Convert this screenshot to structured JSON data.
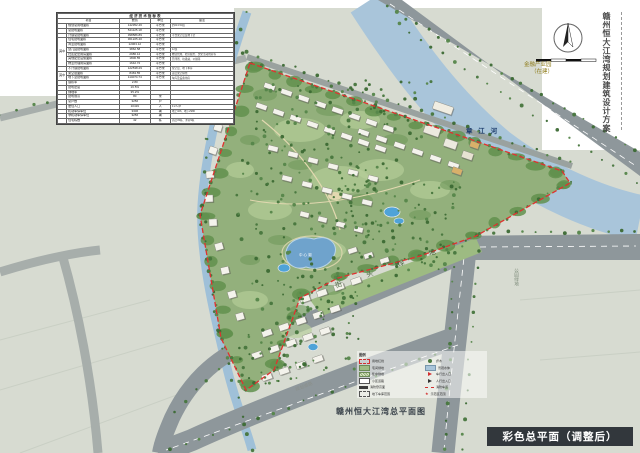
{
  "sheet": {
    "vertical_title": "赣州恒大江湾规划建筑设计方案",
    "banner_title": "彩色总平面（调整后）",
    "plan_caption": "赣州恒大江湾总平面图"
  },
  "map_labels": {
    "river": "章 江 河",
    "financial_park_l1": "金融产业园",
    "financial_park_l2": "（在建）",
    "street_green": "街 头 绿 地",
    "park_green": "公园绿地",
    "lake": "中心湖",
    "road_name": "规划道路"
  },
  "table": {
    "title": "经济技术指标表",
    "headers": [
      "项目",
      "数值",
      "单位",
      "备注"
    ],
    "rows": [
      [
        "",
        "规划总用地面积",
        "142352.46",
        "平方米",
        "约213.53亩"
      ],
      [
        "",
        "总建筑面积",
        "521125.18",
        "平方米",
        ""
      ],
      [
        "",
        "计容总建筑面积",
        "398586.89",
        "平方米",
        "不含架空层及地下室"
      ],
      [
        "其中",
        "住宅建筑面积",
        "361225.40",
        "平方米",
        ""
      ],
      [
        "其中",
        "商业建筑面积",
        "12063.12",
        "平方米",
        ""
      ],
      [
        "其中",
        "幼儿园建筑面积",
        "3862.58",
        "平方米",
        "12班"
      ],
      [
        "其中",
        "社区配套用房面积",
        "2986.12",
        "平方米",
        "物业管理、社区服务、文化活动用房等"
      ],
      [
        "其中",
        "其他配套设施面积",
        "1806.55",
        "平方米",
        "开闭所、垃圾站、公厕等"
      ],
      [
        "其中",
        "物业管理用房面积",
        "1642.72",
        "平方米",
        ""
      ],
      [
        "",
        "不计容建筑面积",
        "122538.29",
        "平方米",
        "架空层、地下车库"
      ],
      [
        "其中",
        "架空层面积",
        "8463.55",
        "平方米",
        "首层架空绿化"
      ],
      [
        "其中",
        "地下室建筑面积",
        "114074.74",
        "平方米",
        "车库及设备用房"
      ],
      [
        "",
        "容积率",
        "2.80",
        "",
        ""
      ],
      [
        "",
        "建筑密度",
        "16.5%",
        "",
        ""
      ],
      [
        "",
        "绿地率",
        "35.2%",
        "",
        ""
      ],
      [
        "",
        "建筑限高",
        "80",
        "米",
        ""
      ],
      [
        "",
        "总户数",
        "3256",
        "户",
        ""
      ],
      [
        "",
        "居住人口",
        "10419",
        "人",
        "3.2人/户"
      ],
      [
        "",
        "机动车停车位",
        "3306",
        "辆",
        "地上326、地下2980"
      ],
      [
        "",
        "非机动车停车位",
        "3256",
        "辆",
        ""
      ],
      [
        "",
        "住宅栋数",
        "42",
        "栋",
        "高层33栋、洋房9栋"
      ]
    ]
  },
  "legend": {
    "title": "图例",
    "left": [
      {
        "type": "reddash",
        "label": "用地红线"
      },
      {
        "type": "green",
        "label": "宅间绿地"
      },
      {
        "type": "hatch",
        "label": "集中绿地"
      },
      {
        "type": "road",
        "label": "小区道路"
      },
      {
        "type": "box",
        "label": "消防登高面"
      },
      {
        "type": "dashbox",
        "label": "地下车库范围"
      }
    ],
    "right": [
      {
        "type": "tree",
        "label": "乔木"
      },
      {
        "type": "water",
        "label": "景观水体"
      },
      {
        "type": "arrowred",
        "label": "车行出入口"
      },
      {
        "type": "arrow",
        "label": "人行出入口"
      },
      {
        "type": "dashline",
        "label": "消防车道"
      },
      {
        "type": "star",
        "label": "示范区范围"
      }
    ]
  },
  "colors": {
    "boundary_red": "#e0312f",
    "river_blue": "#a9c5da",
    "road_gray": "#8e979b",
    "site_green": "#93b07c",
    "banner_bg": "#32373c"
  }
}
